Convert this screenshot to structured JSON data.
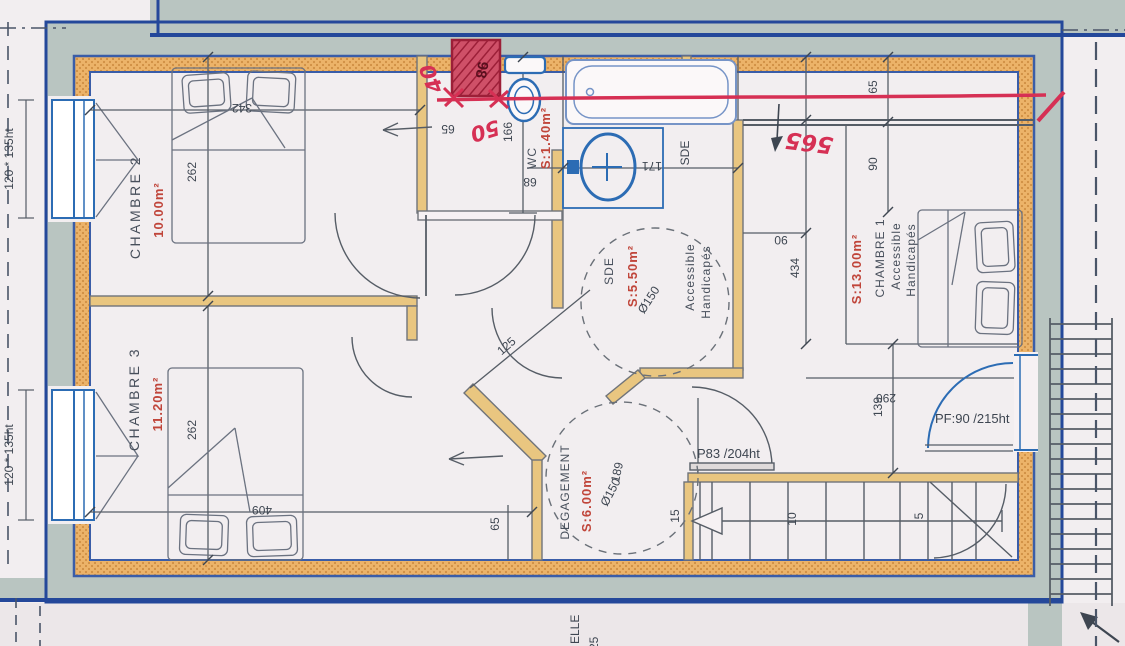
{
  "plan": {
    "rooms": {
      "chambre2": {
        "name": "CHAMBRE 2",
        "area": "10.00m²"
      },
      "chambre3": {
        "name": "CHAMBRE 3",
        "area": "11.20m²"
      },
      "chambre1": {
        "name": "CHAMBRE 1",
        "area": "S:13.00m²",
        "accessible_line1": "Accessible",
        "accessible_line2": "Handicapés"
      },
      "wc": {
        "name": "WC",
        "area": "S:1.40m²"
      },
      "sde": {
        "name": "SDE",
        "area": "S:5.50m²",
        "corner_label": "SDE",
        "accessible_line1": "Accessible",
        "accessible_line2": "Handicapés",
        "turning_circle": "Ø150"
      },
      "degagement": {
        "name": "DEGAGEMENT",
        "area": "S:6.00m²",
        "turning_circle": "Ø150"
      }
    },
    "dimensions": {
      "d342": "342",
      "d262_ch2": "262",
      "d409": "409",
      "d262_ch3": "262",
      "d166": "166",
      "d68": "68",
      "d65_hall": "65",
      "d171": "171",
      "d90_top": "90",
      "d434": "434",
      "d290": "290",
      "d90_right": "90",
      "d65_right": "65",
      "d139": "139",
      "d125": "125",
      "d189": "189",
      "d15": "15",
      "d10": "10",
      "d5": "5",
      "d65_bottom": "65"
    },
    "openings": {
      "stair_door": "P83 /204ht",
      "exterior_door": "PF:90 /215ht",
      "window_top": "120 * 135ht",
      "window_bottom": "120 * 135ht"
    },
    "handwritten": {
      "a40": "40",
      "a50": "50",
      "a565": "565",
      "box_label": "98"
    },
    "scale_text": {
      "line1": "ELLE",
      "line2": "25"
    },
    "colors": {
      "hand_red": "#d63054",
      "print_red": "#c0453a",
      "wall_fill": "#ecb369",
      "band": "#b9c5c1",
      "outline_blue": "#24489a",
      "fixture_blue": "#2c6cb4",
      "ink": "#3e4651"
    }
  }
}
